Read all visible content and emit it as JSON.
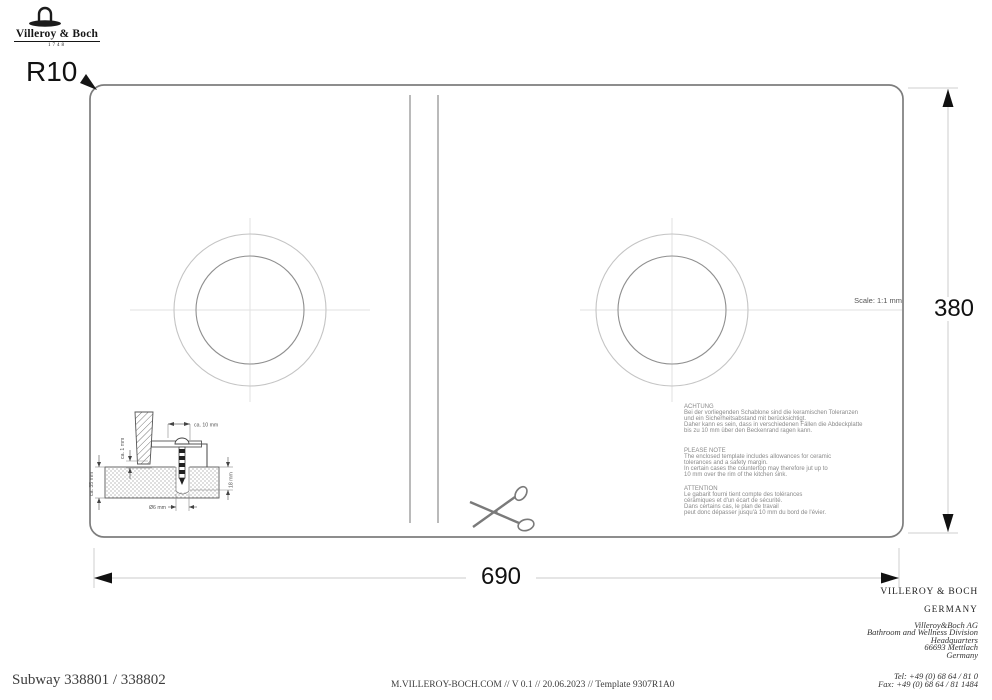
{
  "logo": {
    "brand": "Villeroy & Boch",
    "year": "1748"
  },
  "template_drawing": {
    "corner_radius": "R10",
    "scale_note": "Scale: 1:1 mm",
    "width_mm": "690",
    "height_mm": "380"
  },
  "detail_inset": {
    "dim_offset_top": "ca. 10 mm",
    "dim_gap_left": "ca. 1 mm",
    "dim_thickness_left": "ca. 35 mm",
    "dim_depth_right": "18 mm",
    "dim_hole_bottom": "Ø6 mm"
  },
  "notes": {
    "de_title": "ACHTUNG",
    "de_body": "Bei der vorliegenden Schablone sind die keramischen Toleranzen\nund ein Sicherheitsabstand mit berücksichtigt.\nDaher kann es sein, dass in verschiedenen Fällen die Abdeckplatte\nbis zu 10 mm über den Beckenrand ragen kann.",
    "en_title": "PLEASE NOTE",
    "en_body": "The enclosed template includes allowances for ceramic\ntolerances and a safety margin.\nIn certain cases the countertop may therefore jut up to\n10 mm over the rim of the kitchen sink.",
    "fr_title": "ATTENTION",
    "fr_body": "Le gabarit fourni tient compte des tolérances\ncéramiques et d'un écart de sécurité.\nDans certains cas, le plan de travail\npeut donc dépasser jusqu'à 10 mm du bord de l'évier.",
    "text_color": "#8a8a8a"
  },
  "footer": {
    "model": "Subway 338801 / 338802",
    "meta": "M.VILLEROY-BOCH.COM // V 0.1 // 20.06.2023 // Template 9307R1A0",
    "company": "VILLEROY & BOCH",
    "country": "GERMANY",
    "address": "Villeroy&Boch AG\nBathroom and Wellness Division\nHeadquarters\n66693 Mettlach\nGermany",
    "phone": "Tel:  +49 (0) 68 64 / 81 0\nFax:  +49 (0) 68 64 / 81 1484"
  },
  "colors": {
    "ink": "#1a1a1a",
    "outline_gray": "#7d7d7d",
    "divider_gray": "#9c9c9c",
    "circle_outer_gray": "#c4c4c4",
    "circle_inner_gray": "#8f8f8f",
    "centerline_gray": "#e2e2e2",
    "dimension_line_gray": "#d5d5d5"
  }
}
